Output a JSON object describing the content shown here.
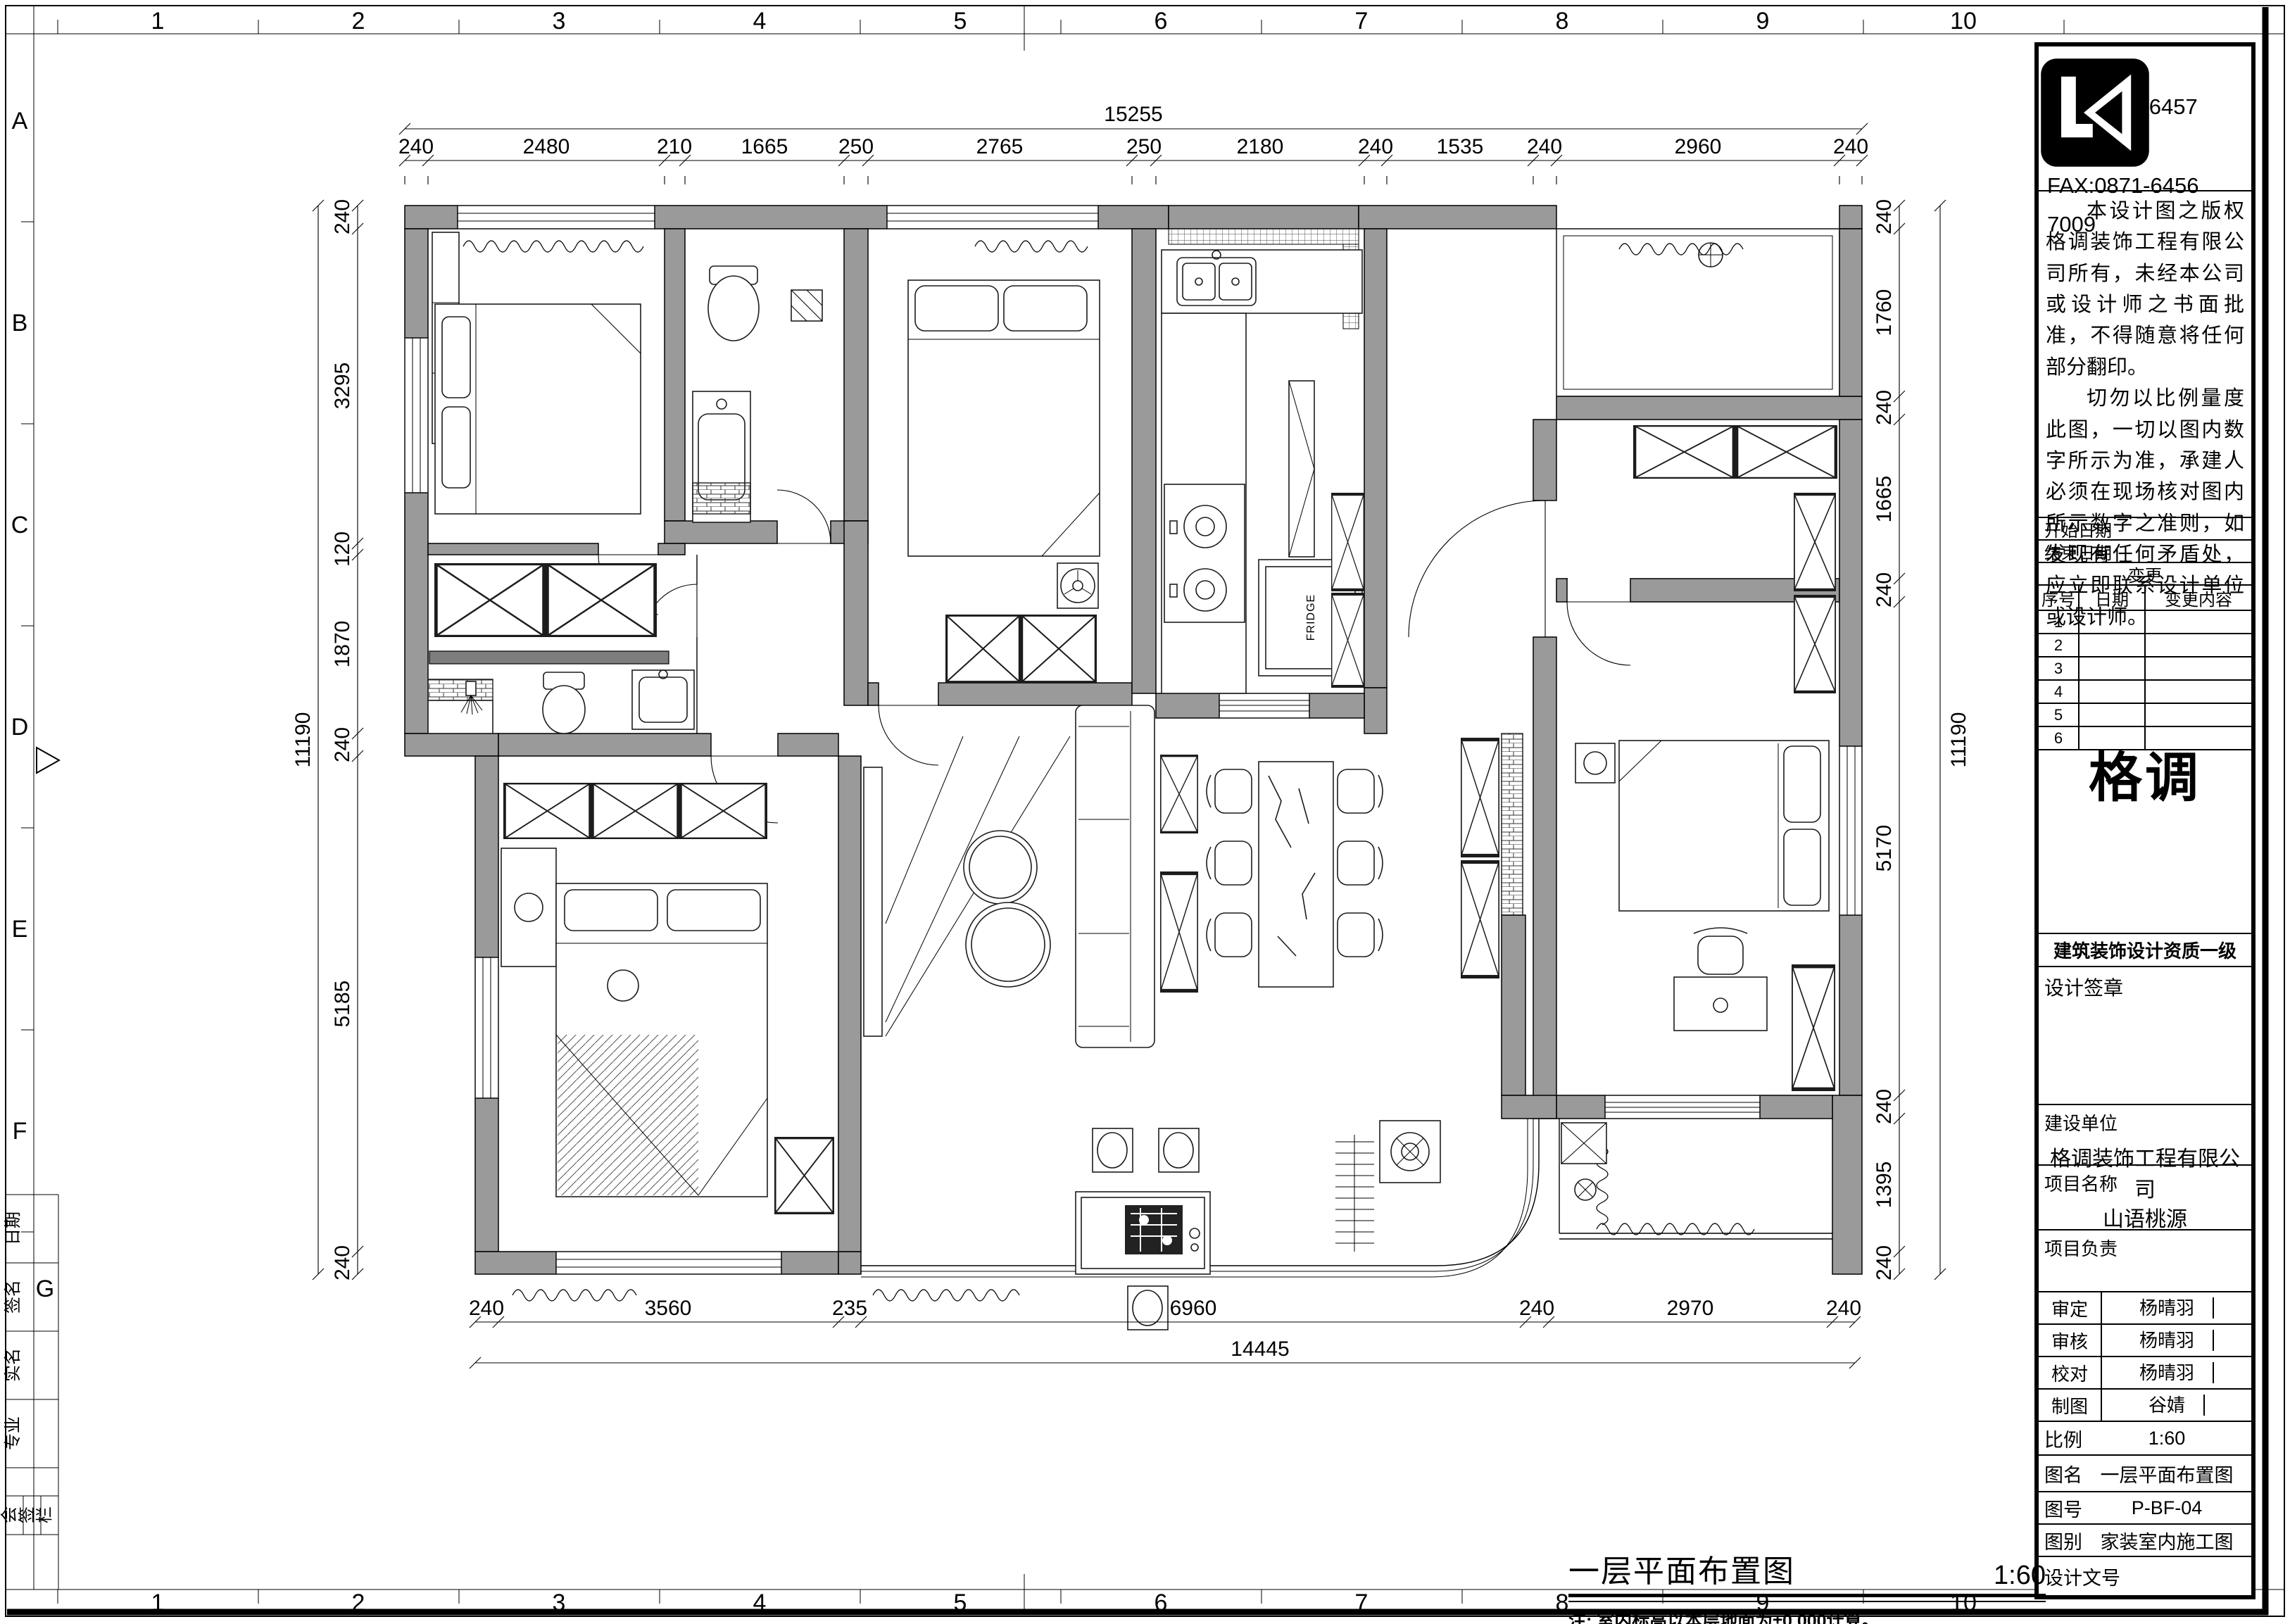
{
  "sheet": {
    "ruler": {
      "cols": [
        "1",
        "2",
        "3",
        "4",
        "5",
        "6",
        "7",
        "8",
        "9",
        "10"
      ],
      "rows": [
        "A",
        "B",
        "C",
        "D",
        "E",
        "F",
        "G"
      ]
    },
    "side_strip": {
      "cells": [
        "日期",
        "签名",
        "实名",
        "专业"
      ],
      "stamp": [
        "会",
        "签",
        "栏"
      ]
    }
  },
  "title_block": {
    "tel": "TEL:0871-6457 2009",
    "fax": "FAX:0871-6456 7009",
    "notes": [
      "本设计图之版权格调装饰工程有限公司所有，未经本公司或设计师之书面批准，不得随意将任何部分翻印。",
      "切勿以比例量度此图，一切以图内数字所示为准，承建人必须在现场核对图内所示数字之准则，如发现有任何矛盾处，应立即联系设计单位或设计师。"
    ],
    "start_date_label": "开始日期",
    "end_date_label": "结束日期",
    "change_label": "变更",
    "change_table": {
      "headers": [
        "序号",
        "日期",
        "变更内容"
      ],
      "rows": [
        "1",
        "2",
        "3",
        "4",
        "5",
        "6"
      ]
    },
    "logo": {
      "brand": "格调",
      "cert": "建筑装饰设计资质一级"
    },
    "sign_label": "设计签章",
    "client_label": "建设单位",
    "client": "格调装饰工程有限公司",
    "project_label": "项目名称",
    "project": "山语桃源",
    "lead_label": "项目负责",
    "rows": [
      {
        "label": "审定",
        "value": "杨晴羽"
      },
      {
        "label": "审核",
        "value": "杨晴羽"
      },
      {
        "label": "校对",
        "value": "杨晴羽"
      },
      {
        "label": "制图",
        "value": "谷婧"
      },
      {
        "label": "比例",
        "value": "1:60"
      },
      {
        "label": "图名",
        "value": "一层平面布置图"
      },
      {
        "label": "图号",
        "value": "P-BF-04"
      },
      {
        "label": "图别",
        "value": "家装室内施工图"
      },
      {
        "label": "设计文号",
        "value": ""
      }
    ]
  },
  "drawing": {
    "title": "一层平面布置图",
    "scale": "1:60",
    "note": "注: 室内标高以本层地面为±0.000计算。",
    "fridge_label": "FRIDGE",
    "dims": {
      "top_total": "15255",
      "top": [
        "240",
        "2480",
        "210",
        "1665",
        "250",
        "2765",
        "250",
        "2180",
        "240",
        "1535",
        "240",
        "2960",
        "240"
      ],
      "bottom": [
        "240",
        "3560",
        "235",
        "6960",
        "240",
        "2970",
        "240"
      ],
      "bottom_total": "14445",
      "left": [
        "240",
        "3295",
        "120",
        "1870",
        "240",
        "5185",
        "240"
      ],
      "left_total": "11190",
      "right": [
        "240",
        "1760",
        "240",
        "1665",
        "240",
        "5170",
        "240",
        "1395",
        "240"
      ],
      "right_total": "11190"
    }
  }
}
